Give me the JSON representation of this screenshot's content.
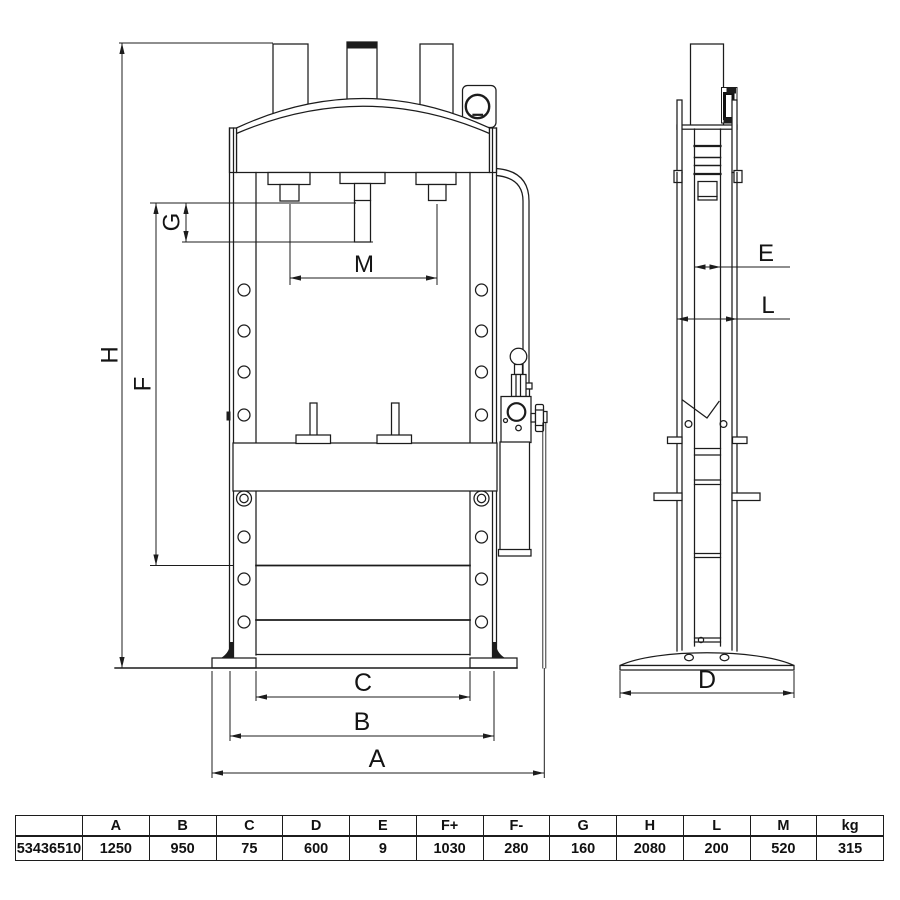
{
  "drawing": {
    "labels": {
      "A": "A",
      "B": "B",
      "C": "C",
      "D": "D",
      "E": "E",
      "F": "F",
      "G": "G",
      "H": "H",
      "L": "L",
      "M": "M"
    },
    "line_color": "#1c1c1c"
  },
  "spec_table": {
    "headers": [
      "",
      "A",
      "B",
      "C",
      "D",
      "E",
      "F+",
      "F-",
      "G",
      "H",
      "L",
      "M",
      "kg"
    ],
    "row": [
      "53436510",
      "1250",
      "950",
      "75",
      "600",
      "9",
      "1030",
      "280",
      "160",
      "2080",
      "200",
      "520",
      "315"
    ]
  }
}
